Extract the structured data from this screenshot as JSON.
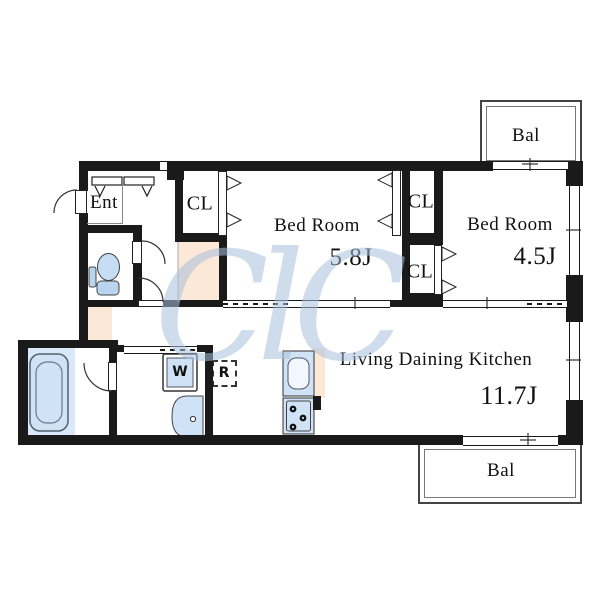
{
  "watermark_text": "ClC",
  "colors": {
    "wall": "#1a1a1a",
    "flooring": "#fce8d7",
    "fixture_blue": "#cfe2f6",
    "wet_area_blue": "#d9e8f8",
    "watermark_blue": "#a9c0dc"
  },
  "rooms": {
    "entrance": {
      "label": "Ent"
    },
    "closet_left": {
      "label": "CL"
    },
    "closet_mid_top": {
      "label": "CL"
    },
    "closet_mid_bottom": {
      "label": "CL"
    },
    "bedroom1": {
      "label": "Bed Room",
      "size": "5.8J"
    },
    "bedroom2": {
      "label": "Bed Room",
      "size": "4.5J"
    },
    "ldk": {
      "label": "Living Daining Kitchen",
      "size": "11.7J"
    },
    "balcony_top": {
      "label": "Bal"
    },
    "balcony_bottom": {
      "label": "Bal"
    }
  },
  "fixtures": {
    "washing_machine": "W",
    "refrigerator": "R"
  }
}
